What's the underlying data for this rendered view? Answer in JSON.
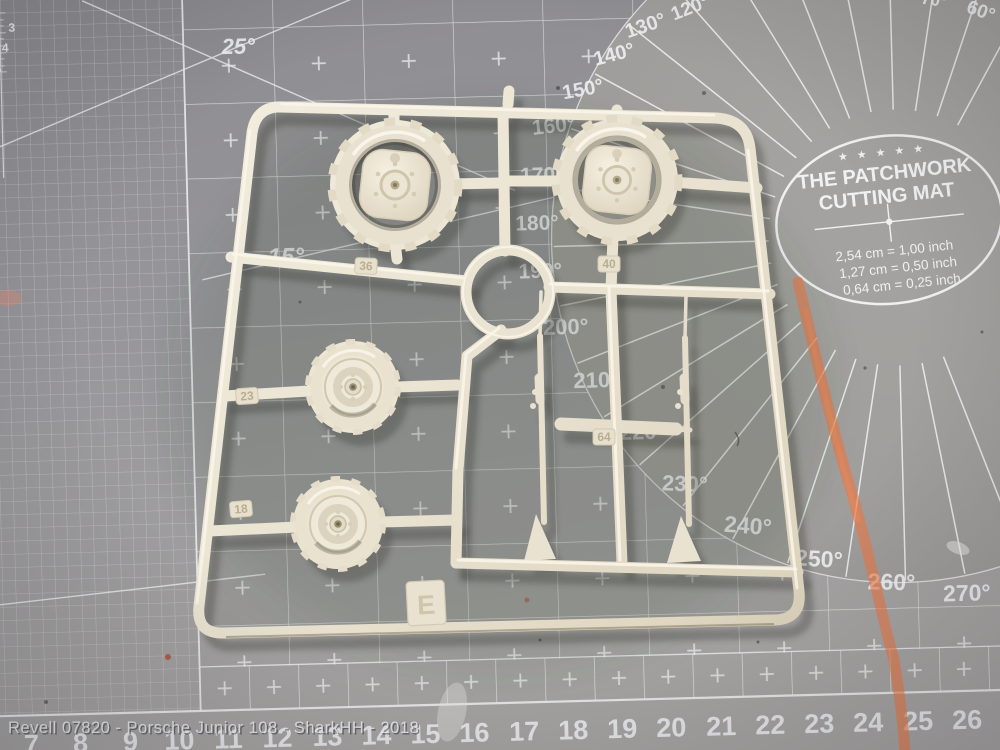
{
  "watermark": "Revell 07820 - Porsche Junior 108 - SharkHH - 2018",
  "mat": {
    "logo": {
      "stars": "★ ★ ★ ★ ★",
      "line1": "THE PATCHWORK",
      "line2": "CUTTING MAT",
      "conv1": "2,54 cm = 1,00 inch",
      "conv2": "1,27 cm = 0,50 inch",
      "conv3": "0,64 cm = 0,25 inch"
    },
    "angles": [
      "25°",
      "15°",
      "60°",
      "70°",
      "120°",
      "130°",
      "140°",
      "150°",
      "160°",
      "170°",
      "180°",
      "190°",
      "200°",
      "210°",
      "220°",
      "230°",
      "240°",
      "250°",
      "260°",
      "270°"
    ],
    "ruler_bottom": [
      "7",
      "8",
      "9",
      "10",
      "11",
      "12",
      "13",
      "14",
      "15",
      "16",
      "17",
      "18",
      "19",
      "20",
      "21",
      "22",
      "23",
      "24",
      "25",
      "26"
    ],
    "ruler_left": [
      "3",
      "4",
      "5"
    ],
    "colors": {
      "mat_gray": "#98979a",
      "grid_line": "#ecedf0",
      "crayon_orange": "#ee7743",
      "sprue_cream": "#e9e2d0"
    }
  },
  "sprue": {
    "letter": "E",
    "tags": [
      "36",
      "40",
      "23",
      "18",
      "64"
    ]
  }
}
